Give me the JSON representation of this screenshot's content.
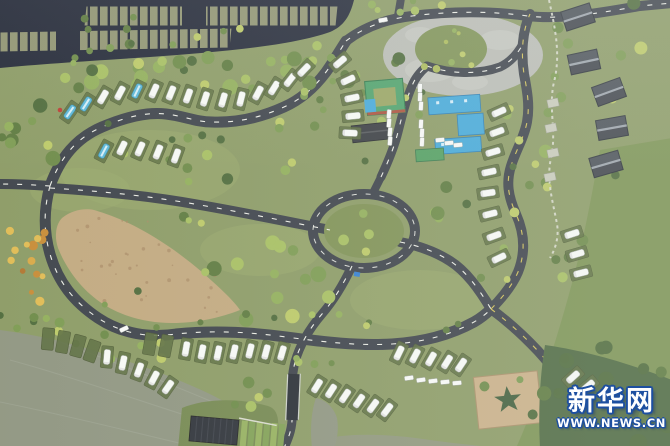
{
  "image": {
    "kind": "aerial-photograph",
    "subject": "RV campground with winding roads, rows of white campers, cabins, central service buildings and a lake shore"
  },
  "watermark": {
    "site_name": "新华网",
    "site_url": "WWW.NEWS.CN",
    "fill": "#ffffff",
    "outline": "#1d4fa0"
  },
  "palette": {
    "grass": "#8a9a60",
    "grass_light": "#9aac6a",
    "field": "#79924e",
    "forest": "#4d6a3e",
    "water": "#8e947e",
    "road": "#3e444b",
    "bridge": "#2b3036",
    "lot": "#262b3a",
    "stall": "#8f936e",
    "dash": "#e9eae2",
    "dash_yellow": "#d2c04e",
    "plaza_concrete": "#b7b9b1",
    "plaza_tan": "#c1a67a",
    "tan_square": "#c9ad82",
    "rv_white": "#f3f5f1",
    "rv_blue": "#55b7d9",
    "pad": "#5d6f3e",
    "cabin": "#4b5158",
    "cabin_ridge": "#9aa2a9",
    "roof_green": "#4aa267",
    "roof_blue": "#3fa8da",
    "roof_dark": "#3b3e42",
    "roof_green2": "#4f9f5c",
    "roof_red": "#b05038",
    "path_white": "#d6d8c9",
    "star_hedge": "#41603a",
    "trees": [
      "#5d7a3c",
      "#6b8a44",
      "#7a9a4c",
      "#8fae54",
      "#a4bd5a",
      "#4e6c38",
      "#b9c75e"
    ],
    "flowers": [
      "#d9a63e",
      "#c98a2f",
      "#e0b84a",
      "#b3742a"
    ],
    "shrubs": [
      "#a9b952",
      "#b9c75e",
      "#8fae54"
    ]
  }
}
